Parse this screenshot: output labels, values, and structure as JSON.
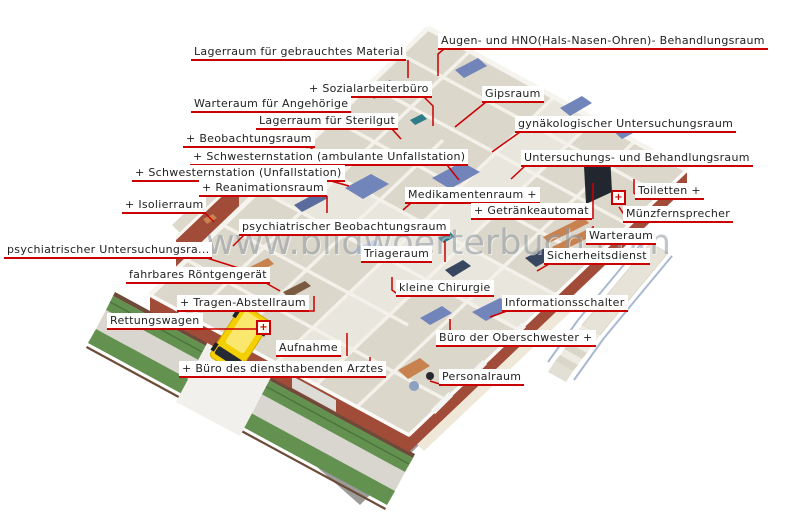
{
  "watermark": "www.bildwoerterbuch.com",
  "markers": [
    {
      "id": "rettungswagen-hotspot",
      "symbol": "+"
    },
    {
      "id": "muenzfernsprecher-hotspot",
      "symbol": "+"
    }
  ],
  "labels": [
    {
      "id": "lagerraum-gebrauchtes-material",
      "text": "Lagerraum für gebrauchtes Material"
    },
    {
      "id": "augen-hno-behandlungsraum",
      "text": "Augen- und HNO(Hals-Nasen-Ohren)- Behandlungsraum"
    },
    {
      "id": "sozialarbeiterbuero",
      "text": "+ Sozialarbeiterbüro"
    },
    {
      "id": "warteraum-fuer-angehoerige",
      "text": "Warteraum für Angehörige"
    },
    {
      "id": "gipsraum",
      "text": "Gipsraum"
    },
    {
      "id": "lagerraum-fuer-sterilgut",
      "text": "Lagerraum für Sterilgut"
    },
    {
      "id": "gynaekologischer-untersuchungsraum",
      "text": "gynäkologischer Untersuchungsraum"
    },
    {
      "id": "beobachtungsraum",
      "text": "+ Beobachtungsraum"
    },
    {
      "id": "schwesternstation-ambulante-unfallstation",
      "text": "+ Schwesternstation (ambulante Unfallstation)"
    },
    {
      "id": "schwesternstation-unfallstation",
      "text": "+ Schwesternstation (Unfallstation)"
    },
    {
      "id": "reanimationsraum",
      "text": "+ Reanimationsraum"
    },
    {
      "id": "isolierraum",
      "text": "+ Isolierraum"
    },
    {
      "id": "psychiatrischer-beobachtungsraum",
      "text": "psychiatrischer Beobachtungsraum"
    },
    {
      "id": "psychiatrischer-untersuchungsraum",
      "text": "psychiatrischer Untersuchungsra..."
    },
    {
      "id": "fahrbares-roentgengeraet",
      "text": "fahrbares Röntgengerät"
    },
    {
      "id": "tragen-abstellraum",
      "text": "+ Tragen-Abstellraum"
    },
    {
      "id": "rettungswagen",
      "text": "Rettungswagen"
    },
    {
      "id": "aufnahme",
      "text": "Aufnahme"
    },
    {
      "id": "buero-des-diensthabenden-arztes",
      "text": "+ Büro des diensthabenden Arztes"
    },
    {
      "id": "kleine-chirurgie",
      "text": "kleine Chirurgie"
    },
    {
      "id": "triageraum",
      "text": "Triageraum"
    },
    {
      "id": "medikamentenraum",
      "text": "Medikamentenraum +"
    },
    {
      "id": "toiletten",
      "text": "Toiletten +"
    },
    {
      "id": "getraenkeautomat",
      "text": "+ Getränkeautomat"
    },
    {
      "id": "muenzfernsprecher",
      "text": "Münzfernsprecher"
    },
    {
      "id": "warteraum",
      "text": "Warteraum"
    },
    {
      "id": "sicherheitsdienst",
      "text": "Sicherheitsdienst"
    },
    {
      "id": "informationsschalter",
      "text": "Informationsschalter"
    },
    {
      "id": "buero-der-oberschwester",
      "text": "Büro der Oberschwester +"
    },
    {
      "id": "personalraum",
      "text": "Personalraum"
    },
    {
      "id": "untersuchungs-und-behandlungsraum",
      "text": "Untersuchungs- und Behandlungsraum"
    }
  ]
}
